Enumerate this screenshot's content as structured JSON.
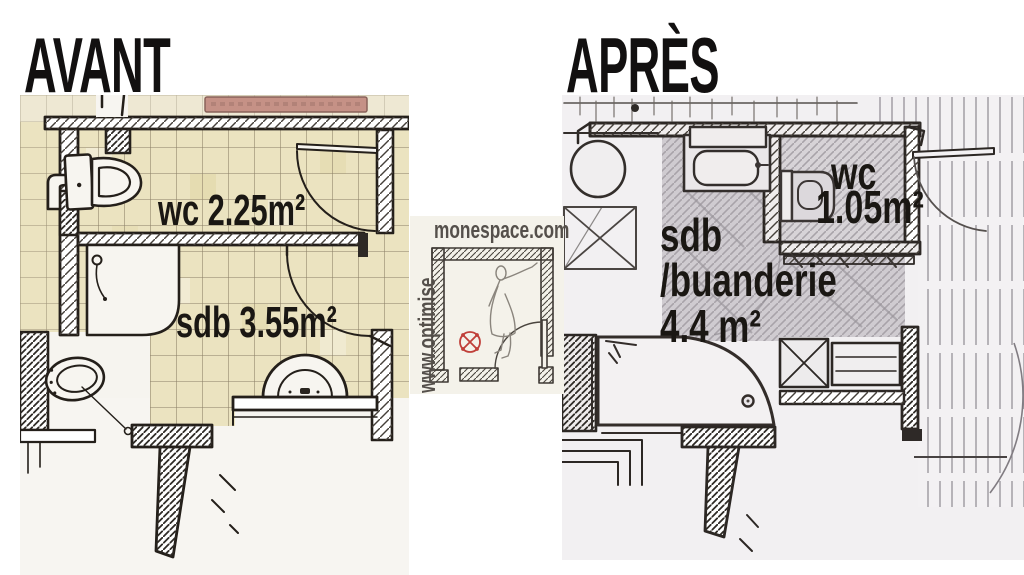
{
  "titles": {
    "before": "AVANT",
    "after": "APRÈS"
  },
  "watermark": {
    "site": "monespace.com",
    "vertical": "www.optimise",
    "text_color": "#55504b",
    "symbol_color": "#c0403a",
    "panel_color": "#f4f2ea"
  },
  "before_plan": {
    "style": "hand sketch, yellow tiled floor",
    "tile_color": "#ebe3c0",
    "bathtub_color": "#c59186",
    "labels": [
      {
        "room": "wc",
        "text": "wc 2.25m²"
      },
      {
        "room": "sdb",
        "text": "sdb 3.55m²"
      }
    ]
  },
  "after_plan": {
    "style": "hand sketch, pencil shaded",
    "shade_color": "#cfcbd0",
    "labels": [
      {
        "room": "wc",
        "text": "wc"
      },
      {
        "room": "wc",
        "text": "1.05m²"
      },
      {
        "room": "sdb",
        "text": "sdb"
      },
      {
        "room": "sdb",
        "text": "/buanderie"
      },
      {
        "room": "sdb",
        "text": "4.4 m²"
      }
    ]
  }
}
